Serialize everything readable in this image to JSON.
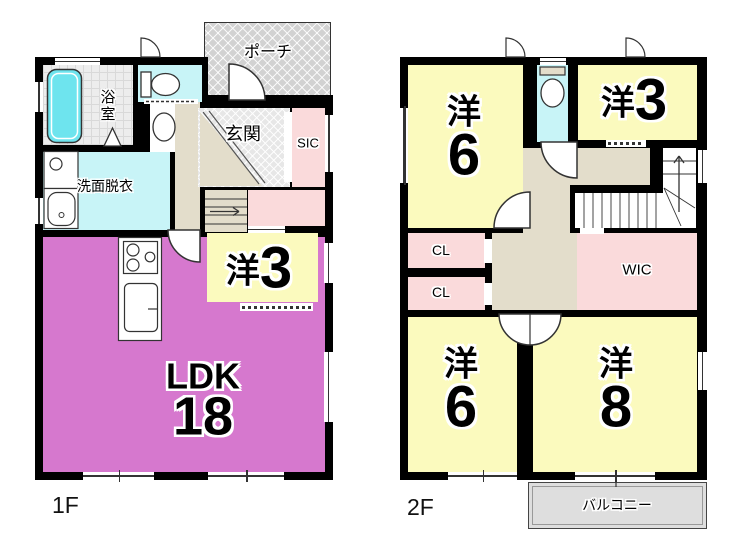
{
  "plan": {
    "floor1": {
      "label": "1F",
      "rooms": {
        "porch": {
          "label": "ポーチ"
        },
        "bath": {
          "label": "浴室"
        },
        "washroom": {
          "label": "洗面脱衣"
        },
        "entrance": {
          "label": "玄関"
        },
        "sic": {
          "label": "SIC"
        },
        "bedroom3": {
          "kanji": "洋",
          "size": "3"
        },
        "ldk": {
          "name": "LDK",
          "size": "18"
        }
      }
    },
    "floor2": {
      "label": "2F",
      "rooms": {
        "bedroom6a": {
          "kanji": "洋",
          "size": "6"
        },
        "bedroom3": {
          "kanji": "洋",
          "size": "3"
        },
        "cl_upper": {
          "label": "CL"
        },
        "cl_lower": {
          "label": "CL"
        },
        "wic": {
          "label": "WIC"
        },
        "bedroom6b": {
          "kanji": "洋",
          "size": "6"
        },
        "bedroom8": {
          "kanji": "洋",
          "size": "8"
        },
        "balcony": {
          "label": "バルコニー"
        }
      }
    },
    "colors": {
      "wall": "#000000",
      "ldk_purple": "#d678ce",
      "bedroom_yellow": "#fbfabe",
      "storage_pink": "#fadadb",
      "wet_area_cyan": "#c8f4f7",
      "hall_beige": "#e3ddcb",
      "bathtub_cyan": "#6ee4ee",
      "porch_gray": "#d2d2d2",
      "balcony_gray": "#dedede"
    }
  }
}
